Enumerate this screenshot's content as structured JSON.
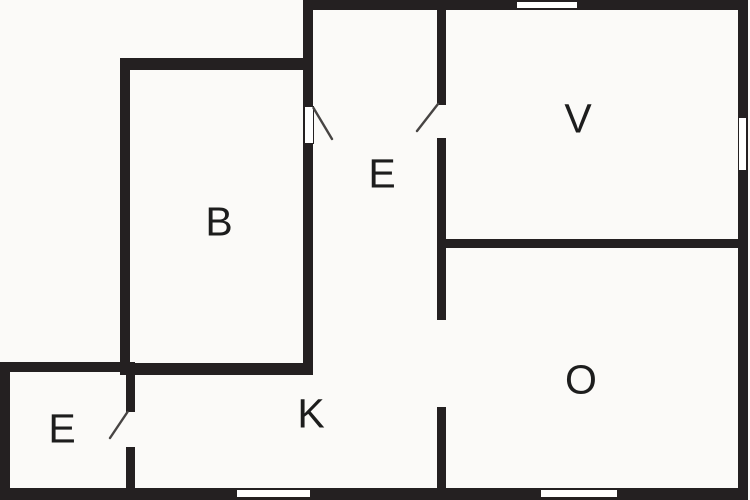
{
  "floorplan": {
    "background_color": "#fbfaf8",
    "wall_color": "#242021",
    "door_line_color": "#474443",
    "label_color": "#1d1d1d",
    "rooms": [
      {
        "id": "room-b",
        "label": "B"
      },
      {
        "id": "hall-e",
        "label": "E"
      },
      {
        "id": "room-v",
        "label": "V"
      },
      {
        "id": "room-k",
        "label": "K"
      },
      {
        "id": "room-o",
        "label": "O"
      },
      {
        "id": "entry-e",
        "label": "E"
      }
    ]
  }
}
